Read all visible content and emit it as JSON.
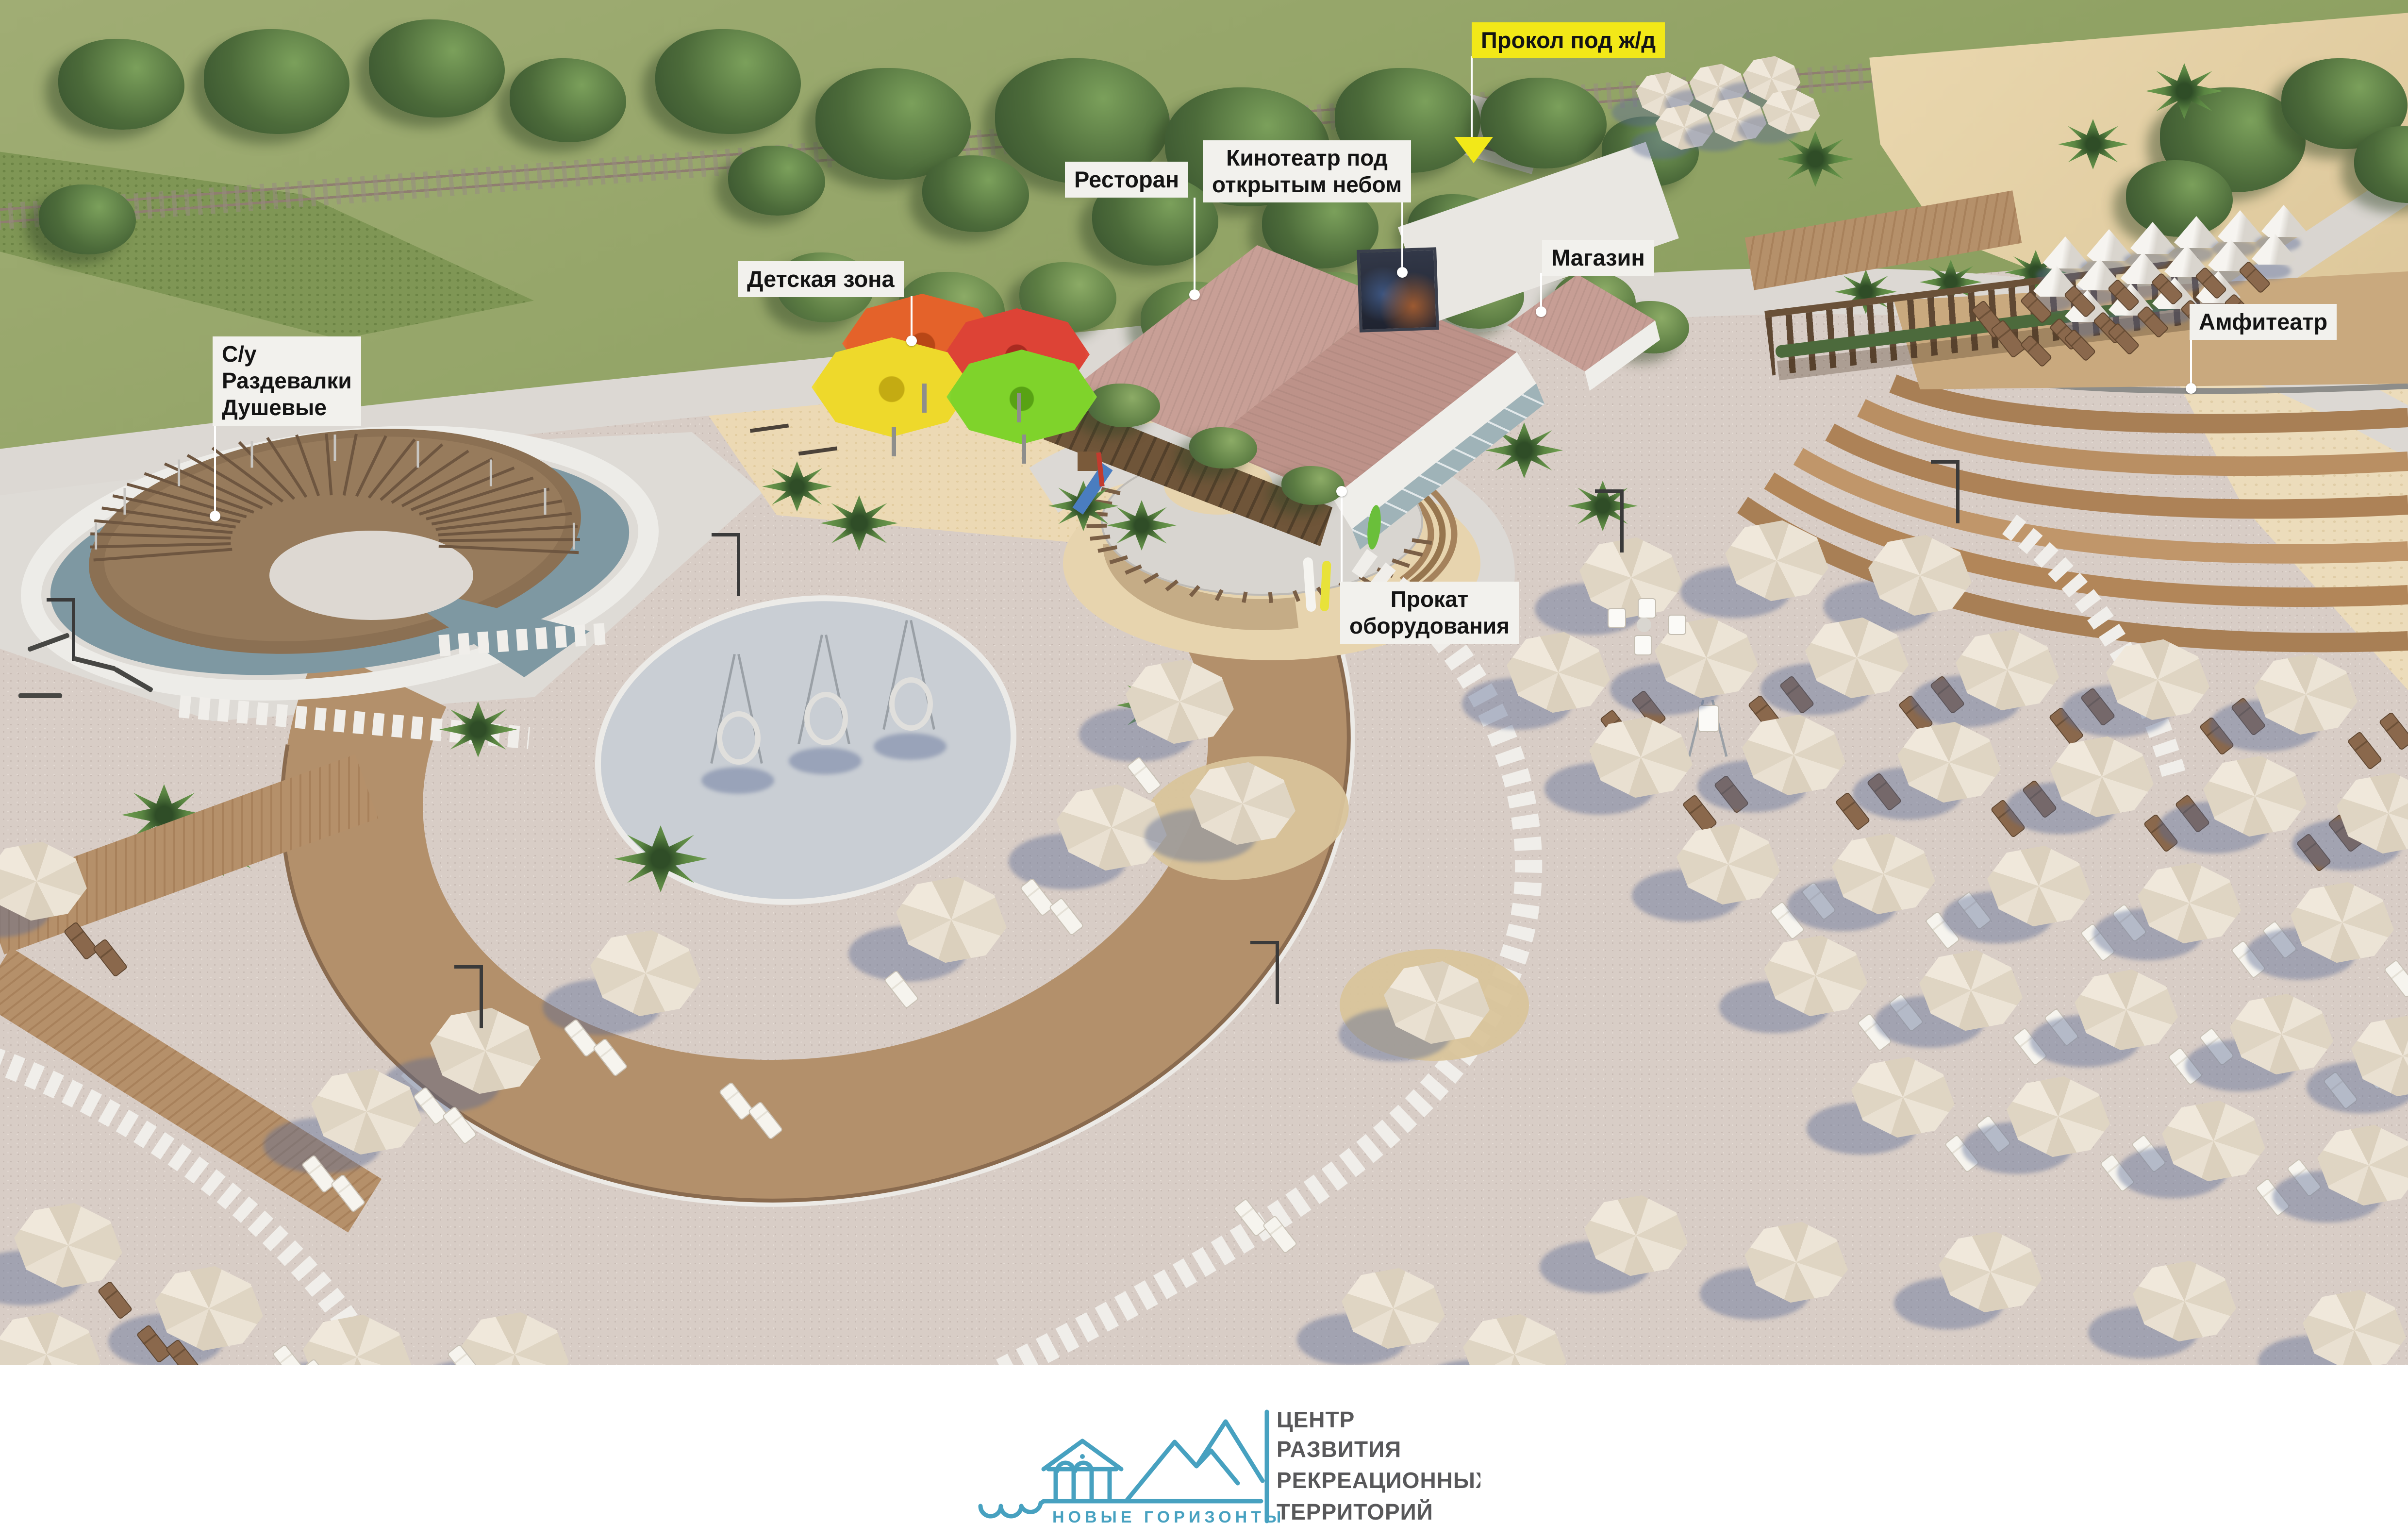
{
  "labels": {
    "prokol": {
      "text": "Прокол под ж/д"
    },
    "restoran": {
      "text": "Ресторан"
    },
    "kinoteatr": {
      "lines": [
        "Кинотеатр под",
        "открытым небом"
      ]
    },
    "magazin": {
      "text": "Магазин"
    },
    "detskaya": {
      "text": "Детская зона"
    },
    "amfiteatr": {
      "text": "Амфитеатр"
    },
    "su": {
      "lines": [
        "С/у",
        "Раздевалки",
        "Душевые"
      ]
    },
    "prokat": {
      "lines": [
        "Прокат",
        "оборудования"
      ]
    }
  },
  "logo": {
    "brand": "НОВЫЕ ГОРИЗОНТЫ",
    "org_lines": [
      "ЦЕНТР",
      "РАЗВИТИЯ",
      "РЕКРЕАЦИОННЫХ",
      "ТЕРРИТОРИЙ"
    ]
  },
  "colors": {
    "label_bg": "#f2f1ed",
    "label_text": "#141414",
    "highlight_yellow": "#f2e818",
    "logo_teal": "#47a1c0",
    "logo_gray": "#58585a",
    "sand": "#d8cdc6",
    "lawn": "#97a46d",
    "forest": "#466333",
    "deck_wood": "#b3906b",
    "roof_rose": "#c49b92",
    "umbrella_cream": "#e9e1d2",
    "canopy_orange": "#e4622a",
    "canopy_red": "#dd4336",
    "canopy_yellow": "#eed92b",
    "canopy_green": "#7fd32b"
  }
}
